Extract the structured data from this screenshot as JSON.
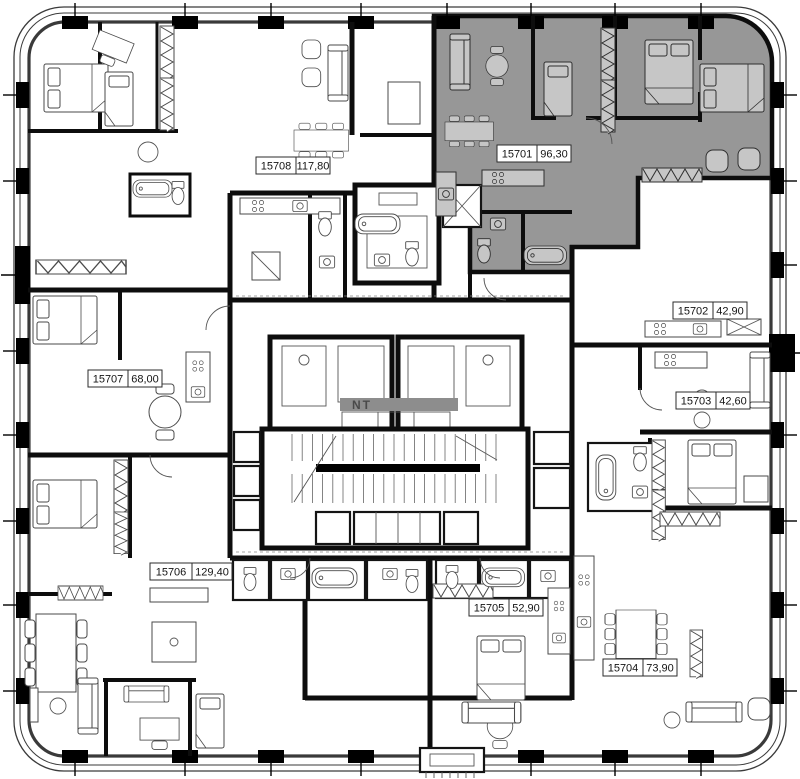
{
  "apartments": [
    {
      "number": "15701",
      "area": "96,30",
      "highlighted": true
    },
    {
      "number": "15702",
      "area": "42,90",
      "highlighted": false
    },
    {
      "number": "15703",
      "area": "42,60",
      "highlighted": false
    },
    {
      "number": "15704",
      "area": "73,90",
      "highlighted": false
    },
    {
      "number": "15705",
      "area": "52,90",
      "highlighted": false
    },
    {
      "number": "15706",
      "area": "129,40",
      "highlighted": false
    },
    {
      "number": "15707",
      "area": "68,00",
      "highlighted": false
    },
    {
      "number": "15708",
      "area": "117,80",
      "highlighted": false
    }
  ],
  "watermark": "NT",
  "colors": {
    "highlight": "#979797",
    "wall": "#0d0d0d",
    "watermark_band": "#8d8d8d"
  }
}
